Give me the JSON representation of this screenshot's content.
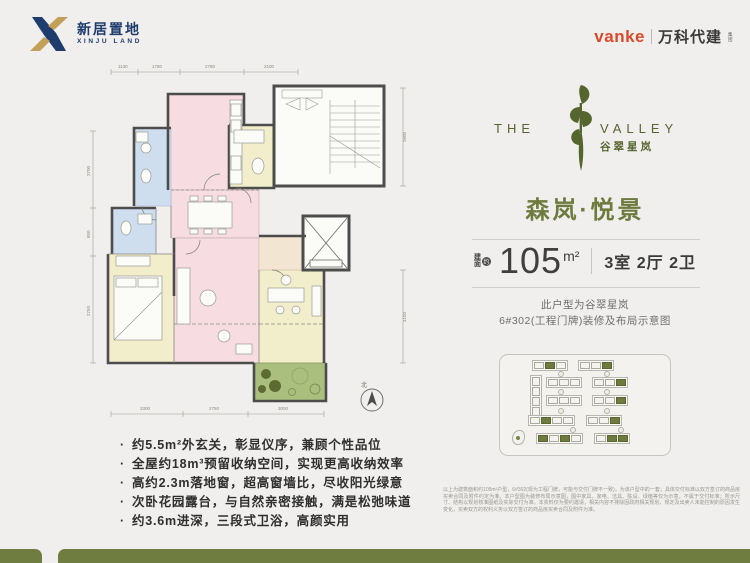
{
  "header": {
    "brand_left": {
      "name_cn": "新居置地",
      "name_en": "XINJU LAND"
    },
    "brand_right": {
      "wordmark": "vanke",
      "name_cn": "万科代建",
      "suffix": "集团"
    }
  },
  "project": {
    "logo_the": "THE",
    "logo_valley": "VALLEY",
    "logo_cn": "谷翠星岚"
  },
  "unit": {
    "title": "森岚·悦景",
    "area_prefix_1": "建",
    "area_prefix_2": "面",
    "area_approx": "约",
    "area_value": "105",
    "area_unit": "m²",
    "layout": "3室 2厅 2卫",
    "note_line1": "此户型为谷翠星岚",
    "note_line2": "6#302(工程门牌)装修及布局示意图"
  },
  "features": [
    "约5.5m²外玄关，彰显仪序，兼顾个性品位",
    "全屋约18m³预留收纳空间，实现更高收纳效率",
    "高约2.3m落地窗，超高窗墙比，尽收阳光绿意",
    "次卧花园露台，与自然亲密接触，满是松弛味道",
    "约3.6m进深，三段式卫浴，高颜实用"
  ],
  "floorplan": {
    "dims_top": [
      "1130",
      "1780",
      "2780",
      "2100"
    ],
    "dims_bottom": [
      "3300",
      "2750",
      "3000"
    ],
    "dims_left": [
      "3700",
      "850",
      "2750"
    ],
    "dims_right": [
      "2600",
      "4150"
    ],
    "compass_label": "北"
  },
  "disclaimer": "以上为建筑面积约105m²户型，6#302(现为工程门牌，可能与交付门牌不一致)，为该户型中的一套；具体交付标准以双方签订的商品房买卖合同及附件约定为准。本户型图为装修布局示意图，图中家具、家电、洁具、陈设、绿植等仅为示意，不属于交付标准；所示尺寸、结构以规划核准图纸及实际交付为准。本资料仅为要约邀请，相关内容不排除因政府相关规划、规定及出卖人未能控制的原因发生变化，买卖双方的权利义务以双方签订的商品房买卖合同及附件为准。"
}
